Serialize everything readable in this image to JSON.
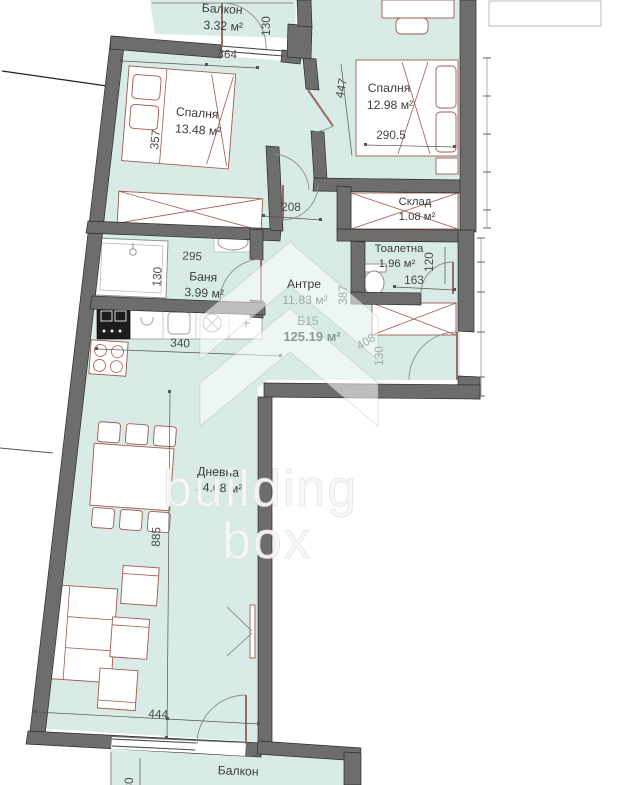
{
  "rooms": {
    "balcony_top": {
      "name": "Балкон",
      "area": "3.32 м²"
    },
    "bedroom_left": {
      "name": "Спалня",
      "area": "13.48 м²"
    },
    "bedroom_right": {
      "name": "Спалня",
      "area": "12.98 м²"
    },
    "storage": {
      "name": "Склад",
      "area": "1.08 м²"
    },
    "toilet": {
      "name": "Тоалетна",
      "area": "1.96 м²"
    },
    "bathroom": {
      "name": "Баня",
      "area": "3.99 м²"
    },
    "hallway": {
      "name": "Антре",
      "area": "11.83 м²"
    },
    "living": {
      "name": "Дневна",
      "area": "34.08 м²"
    },
    "balcony_bottom": {
      "name": "Балкон"
    }
  },
  "unit": {
    "id": "Б15",
    "total_area": "125.19 м²"
  },
  "dims": {
    "top_width": "364",
    "balcony_top_depth": "130",
    "bed_left_len": "357",
    "bed_right_len": "447",
    "bed_right_width": "290.5",
    "corridor": "208",
    "bath_width": "295",
    "bath_depth": "130",
    "toilet_width": "163",
    "toilet_depth": "120",
    "hall_a": "387",
    "hall_b": "408",
    "hall_c": "130",
    "kitchen": "340",
    "living_len": "885",
    "living_width": "444",
    "balcony_bottom_depth": "80"
  },
  "watermark": {
    "line1": "building",
    "line2": "box"
  },
  "colors": {
    "floor": "#d8ebe7",
    "wall": "#6d6d6d",
    "furniture": "#a05a50"
  }
}
